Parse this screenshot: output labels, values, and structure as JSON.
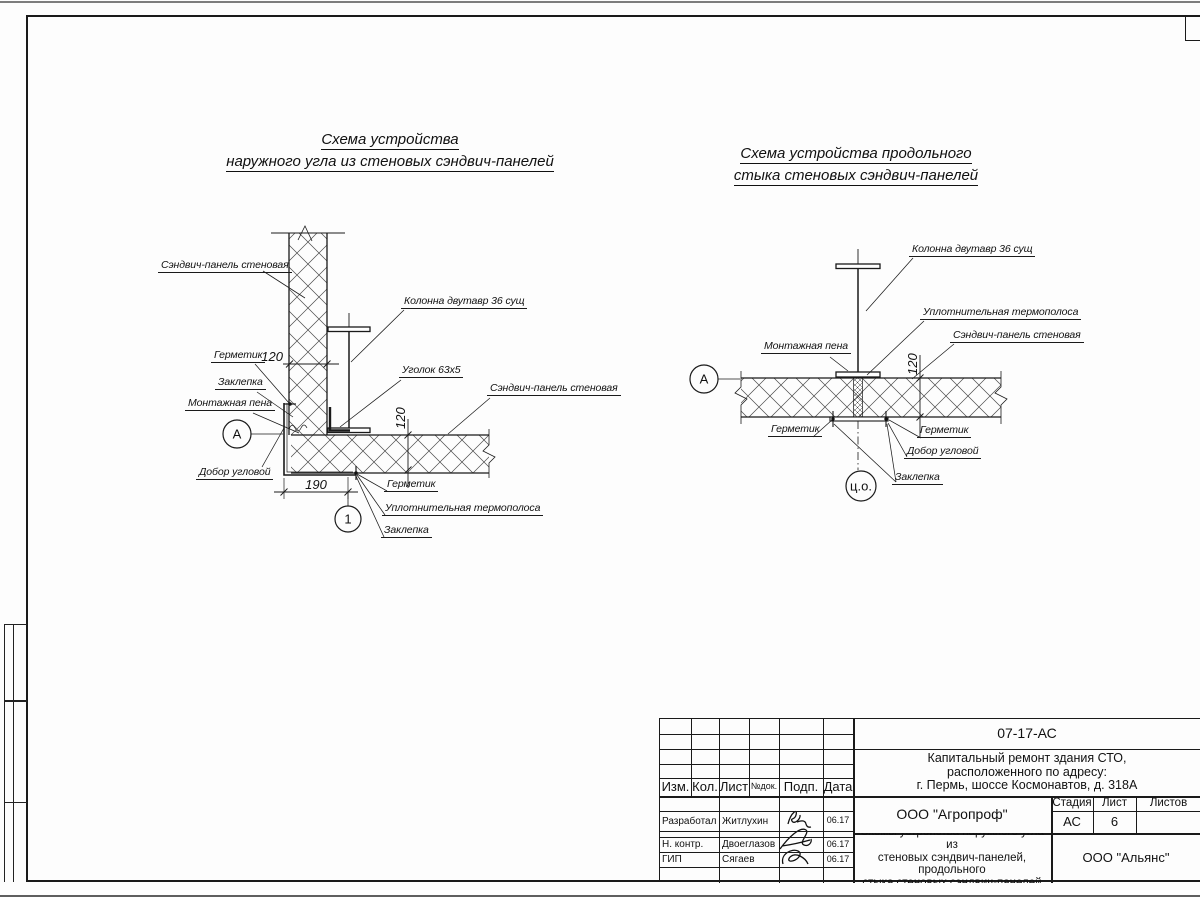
{
  "diagram_left": {
    "title_line1": "Схема устройства",
    "title_line2": "наружного угла из стеновых сэндвич-панелей",
    "labels": {
      "panel_top": "Сэндвич-панель стеновая",
      "column": "Колонна двутавр 36 сущ",
      "sealant_top": "Герметик",
      "rivet_top": "Заклепка",
      "foam": "Монтажная пена",
      "angle": "Уголок 63х5",
      "panel_right": "Сэндвич-панель стеновая",
      "corner_trim": "Добор угловой",
      "sealant_bottom": "Герметик",
      "thermal_strip": "Уплотнительная термополоса",
      "rivet_bottom": "Заклепка"
    },
    "dims": {
      "panel_thickness_top": "120",
      "panel_thickness_right": "120",
      "corner_width": "190"
    },
    "markers": {
      "node": "А",
      "detail": "1"
    }
  },
  "diagram_right": {
    "title_line1": "Схема устройства продольного",
    "title_line2": "стыка стеновых сэндвич-панелей",
    "labels": {
      "column": "Колонна двутавр 36 сущ",
      "thermal_strip": "Уплотнительная термополоса",
      "panel": "Сэндвич-панель стеновая",
      "foam": "Монтажная пена",
      "sealant_left": "Герметик",
      "sealant_right": "Герметик",
      "corner_trim": "Добор угловой",
      "rivet": "Заклепка"
    },
    "dims": {
      "panel_thickness": "120"
    },
    "markers": {
      "node": "А",
      "center": "ц.о."
    }
  },
  "title_block": {
    "doc_number": "07-17-АС",
    "project_line1": "Капитальный ремонт здания СТО,",
    "project_line2": "расположенного по адресу:",
    "project_line3": "г. Пермь, шоссе Космонавтов, д. 318А",
    "col_izm": "Изм.",
    "col_kol": "Кол.",
    "col_list": "Лист",
    "col_ndok": "№док.",
    "col_podp": "Подп.",
    "col_data": "Дата",
    "stage_label": "Стадия",
    "sheet_label": "Лист",
    "sheets_label": "Листов",
    "stage_value": "АС",
    "sheet_value": "6",
    "org_designer": "ООО \"Агропроф\"",
    "sheet_title_line1": "Схемы устройства наружного угла из",
    "sheet_title_line2": "стеновых сэндвич-панелей, продольного",
    "sheet_title_line3": "стыка стеновых сэндвич-панелей",
    "org_customer": "ООО \"Альянс\"",
    "row_developed_role": "Разработал",
    "row_developed_name": "Житлухин",
    "row_developed_date": "06.17",
    "row_ncontr_role": "Н. контр.",
    "row_ncontr_name": "Двоеглазов",
    "row_ncontr_date": "06.17",
    "row_gip_role": "ГИП",
    "row_gip_name": "Сягаев",
    "row_gip_date": "06.17"
  }
}
